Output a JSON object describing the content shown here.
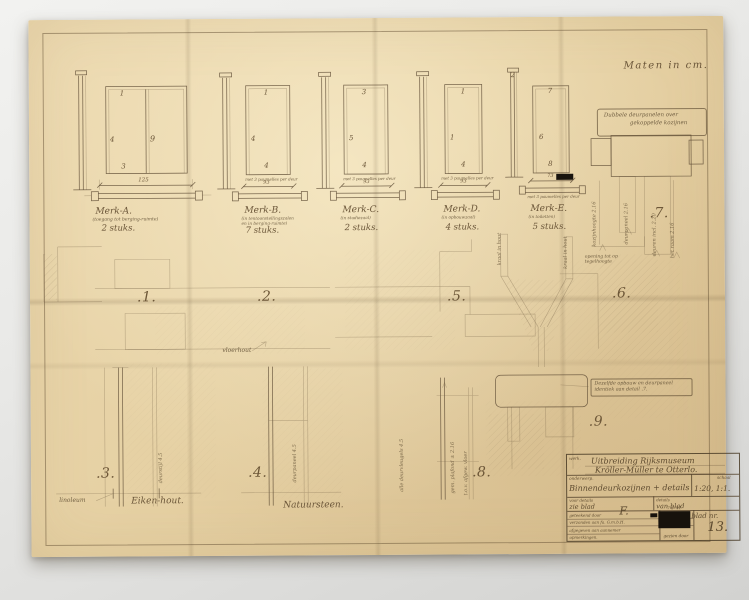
{
  "page": {
    "units_note": "Maten in cm."
  },
  "colors": {
    "paper": "#e6d1a4",
    "ink": "#6b5639",
    "background": "#e9e9e7",
    "redaction": "#17120c"
  },
  "doors": [
    {
      "mark": "Merk-A.",
      "subtitle": "(toegang tot berging-ruimte)",
      "subtitle2": null,
      "count": "2 stuks.",
      "dim": "125",
      "caption": null,
      "refs": [
        "1",
        "4",
        "9",
        "3",
        null
      ]
    },
    {
      "mark": "Merk-B.",
      "subtitle": "(in tentoonstellingszalen",
      "subtitle2": "en in berging-ruimte)",
      "count": "7 stuks.",
      "dim": "93",
      "caption": "met 3 paumelles per deur",
      "refs": [
        "1",
        "4",
        null,
        "4",
        null
      ]
    },
    {
      "mark": "Merk-C.",
      "subtitle": "(in studiezaal)",
      "subtitle2": null,
      "count": "2 stuks.",
      "dim": "93",
      "caption": "met 3 paumelles per deur",
      "refs": [
        "3",
        "5",
        null,
        "4",
        null
      ]
    },
    {
      "mark": "Merk-D.",
      "subtitle": "(in opbouwzaal)",
      "subtitle2": null,
      "count": "4 stuks.",
      "dim": "93",
      "caption": "met 3 paumelles per deur",
      "refs": [
        "1",
        "1",
        null,
        "4",
        null
      ]
    },
    {
      "mark": "Merk-E.",
      "subtitle": "(in toiletten)",
      "subtitle2": null,
      "count": "5 stuks.",
      "dim": "73",
      "caption": "met 3 paumelles per deur",
      "refs": [
        "7",
        "6",
        null,
        "8",
        "2"
      ]
    }
  ],
  "details": {
    "d1": ".1.",
    "d2": ".2.",
    "d3": ".3.",
    "d4": ".4.",
    "d5": ".5.",
    "d6": ".6.",
    "d7": ".7.",
    "d8": ".8.",
    "d9": ".9.",
    "note7a": "Dubbele deurpanelen over",
    "note7b": "gekoppelde kozijnen",
    "note9a": "Dezelfde opbouw en deurpaneel",
    "note9b": "identiek aan detail .7.",
    "note56": "opening tot op tegelhoogte",
    "vloerhout": "vloerhout",
    "linoleum": "linoleum",
    "eikenhout": "Eiken-hout.",
    "natuursteen": "Natuursteen."
  },
  "annotations": {
    "v1": "kozijnhoogte 2.16",
    "v2": "deurpaneel 2.16",
    "v3": "deuren incl. 2.20",
    "v4": "het raam 2.16",
    "v5": "kraal in hout",
    "v6": "kraal in hout",
    "v7": "deurstijl 4.5",
    "v8": "deurpaneel 4.5",
    "v9": "alle deurvleugels 4.5",
    "v10": "gem. plafond ± 2.16",
    "v11": "t.o.v. afgew. vloer"
  },
  "title_block": {
    "werk_label": "werk.",
    "werk_line1": "Uitbreiding Rijksmuseum",
    "werk_line2": "Kröller-Müller te Otterlo.",
    "onderwerp_label": "onderwerp.",
    "onderwerp_value": "Binnendeurkozijnen + details",
    "schaal_label": "schaal",
    "schaal_value": "1:20, 1:1.",
    "voor_details": "voor details",
    "zie_blad": "zie blad",
    "details_label": "details",
    "van_blad": "van blad",
    "row_geteekend": "geteekend door",
    "row_verzonden": "verzonden aan fa. G.m.b.H.",
    "row_afgegeven": "afgegeven aan aannemer",
    "row_opmerkingen": "opmerkingen.",
    "date_scribble": "7-8-'41",
    "signature": "F.",
    "gezien_door": "gezien door",
    "blad_nr_label": "blad nr.",
    "blad_nr_value": "13."
  }
}
